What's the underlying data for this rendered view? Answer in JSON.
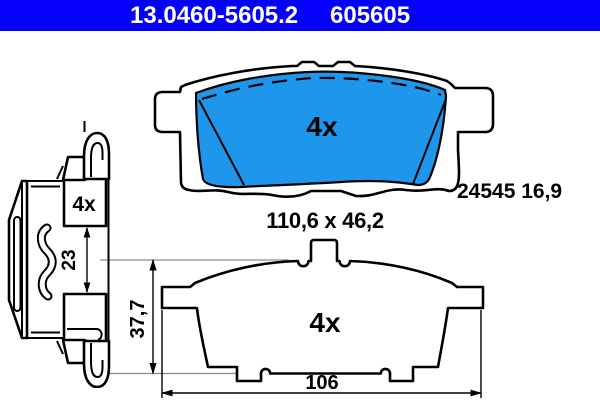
{
  "header": {
    "part_number": "13.0460-5605.2",
    "ref_number": "605605",
    "bg_color": "#0500fa",
    "text_color": "#ffffff"
  },
  "friction_pad_view": {
    "quantity": "4x",
    "edge_code": "24545 16,9",
    "size_label": "110,6 x 46,2",
    "pad_color": "#1e96eb"
  },
  "plate_view": {
    "quantity": "4x",
    "width_mm": "106",
    "height_mm": "37,7"
  },
  "accessory_view": {
    "quantity": "4x",
    "clip_gap_mm": "23"
  }
}
